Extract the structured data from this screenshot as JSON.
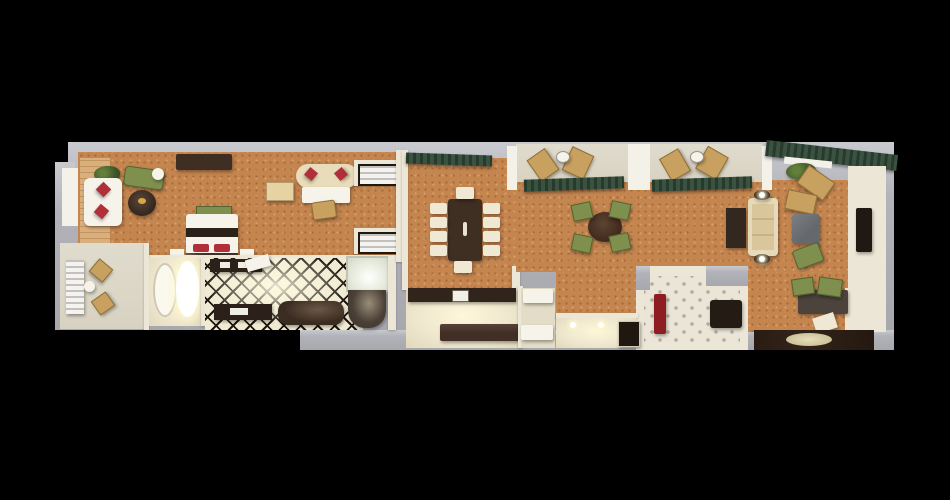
{
  "window": {
    "canvas_width": 950,
    "canvas_height": 500,
    "content": "3D top-down floor plan rendering of a long hotel suite on a black background"
  },
  "palette": {
    "background": "#000000",
    "slab": "#b2b3b9",
    "slab_light": "#c9cacf",
    "wall_cream": "#ece6d6",
    "carpet": "#c4854f",
    "tile_cream": "#f1ead3",
    "tile_line": "#1c1710",
    "dark_wood": "#3f2e22",
    "red_accent": "#b02f39",
    "study_red": "#8e1d22",
    "olive": "#7f904e",
    "awning": "#3a5340",
    "khaki": "#c8a160",
    "cream_furn": "#efe8d5",
    "white_furn": "#f6f3ea",
    "balcony_floor": "#d8d2c2",
    "gray_table": "#65696d",
    "entry_dark": "#33241a",
    "glow": "#fff7d9"
  },
  "scene": {
    "type": "3d-floorplan-top-view",
    "rooms": [
      {
        "name": "master-bedroom",
        "floor": "tan-carpet",
        "furniture": [
          "white-sofa-red-pillows",
          "potted-plant",
          "area-rug",
          "round-side-table",
          "round-coffee-table",
          "tv-console",
          "bed-red-pillows",
          "foot-bench",
          "nightstand-left",
          "nightstand-right",
          "oval-settee-red-pillows",
          "writing-desk",
          "desk-chair",
          "ottoman",
          "wardrobe-upper",
          "wardrobe-lower"
        ]
      },
      {
        "name": "left-balcony",
        "floor": "concrete",
        "furniture": [
          "slatted-lounger",
          "patio-chair-upper",
          "patio-chair-lower",
          "patio-side-table"
        ]
      },
      {
        "name": "tub-room",
        "floor": "cream-tile",
        "furniture": [
          "oval-tub",
          "oval-shower-basin"
        ]
      },
      {
        "name": "master-bathroom",
        "floor": "black-white-diamond-tile",
        "furniture": [
          "vanity-upper",
          "door-leaf",
          "vanity-lower",
          "dark-soaking-tub",
          "glass-shower",
          "dark-shower-basin"
        ]
      },
      {
        "name": "dining-room",
        "floor": "tan-carpet",
        "furniture": [
          "dining-table",
          "side-chairs-left-x4",
          "side-chairs-right-x4",
          "head-chair-top",
          "head-chair-bottom",
          "window-valance"
        ]
      },
      {
        "name": "kitchen",
        "floor": "cream-tile",
        "furniture": [
          "counter-run",
          "microwave",
          "island",
          "service-table-upper",
          "service-table-lower"
        ]
      },
      {
        "name": "great-room",
        "floor": "tan-carpet",
        "furniture": [
          "game-table",
          "game-chairs-x4",
          "window-valance-x2",
          "corner-awning",
          "potted-plant",
          "chaise-lounge-x2",
          "cream-sofa",
          "console-table",
          "table-lamp-x2",
          "gray-coffee-table",
          "accent-chair",
          "wall-cabinetry",
          "wall-tv",
          "work-desk",
          "desk-chairs-green-x2",
          "desk-chair-white",
          "entry-floor",
          "entry-rug"
        ]
      },
      {
        "name": "balcony-one",
        "floor": "stone",
        "furniture": [
          "lounger-x2",
          "patio-round-table"
        ]
      },
      {
        "name": "balcony-two",
        "floor": "stone",
        "furniture": [
          "lounger-x2",
          "patio-round-table"
        ]
      },
      {
        "name": "study",
        "floor": "diamond-pattern-carpet",
        "furniture": [
          "red-sofa",
          "piano"
        ]
      },
      {
        "name": "hallway",
        "floor": "cream-tile",
        "furniture": [
          "minibar-cabinet",
          "ceiling-light-glows"
        ]
      }
    ]
  }
}
